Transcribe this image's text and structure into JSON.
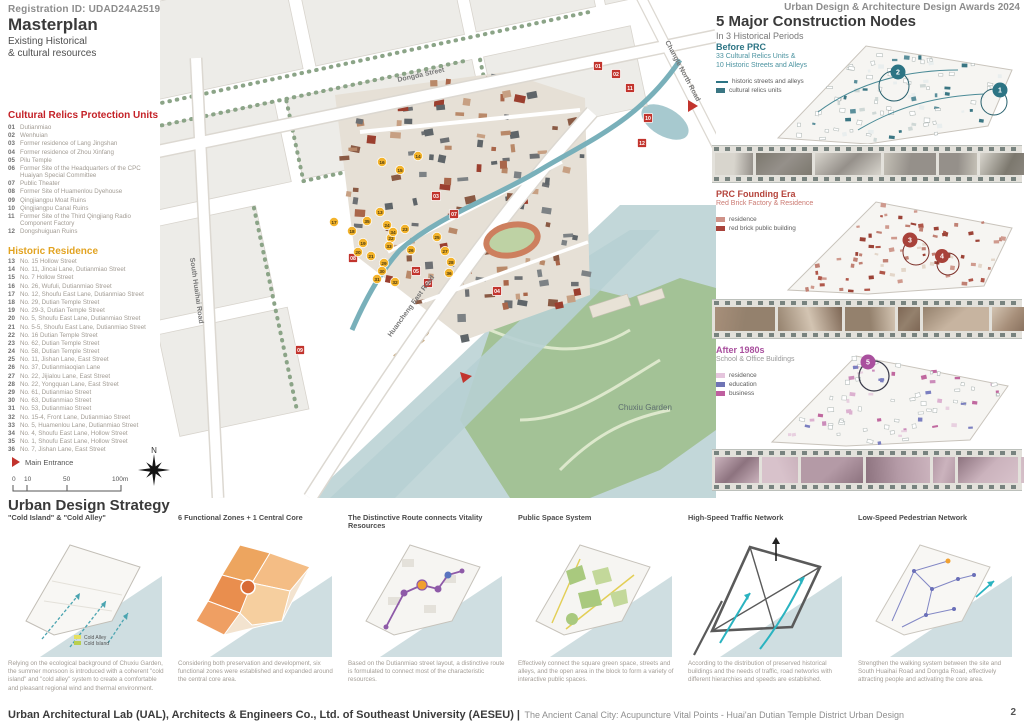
{
  "colors": {
    "relics_red": "#c42127",
    "residence_amber": "#e2a321",
    "teal": "#2c7484",
    "prc_red": "#b5443c",
    "prc_red_light": "#cb7a72",
    "purple": "#a9509e"
  },
  "header": {
    "registration": "Registration ID: UDAD24A2519",
    "title": "Masterplan",
    "subtitle1": "Existing Historical",
    "subtitle2": "& cultural resources"
  },
  "relics": {
    "heading": "Cultural Relics Protection Units",
    "items": [
      {
        "num": "01",
        "label": "Dutianmiao"
      },
      {
        "num": "02",
        "label": "Wenhuian"
      },
      {
        "num": "03",
        "label": "Former residence of Lang Jingshan"
      },
      {
        "num": "04",
        "label": "Former residence of Zhou Xinfang"
      },
      {
        "num": "05",
        "label": "Pilu Temple"
      },
      {
        "num": "06",
        "label": "Former Site of the Headquarters of the CPC Huaiyan Special Committee"
      },
      {
        "num": "07",
        "label": "Public Theater"
      },
      {
        "num": "08",
        "label": "Former Site of Huamenlou Dyehouse"
      },
      {
        "num": "09",
        "label": "Qingjiangpu Moat Ruins"
      },
      {
        "num": "10",
        "label": "Qingjiangpu Canal Ruins"
      },
      {
        "num": "11",
        "label": "Former Site of the Third Qingjiang Radio Component Factory"
      },
      {
        "num": "12",
        "label": "Dongshuiguan Ruins"
      }
    ]
  },
  "residence": {
    "heading": "Historic Residence",
    "items": [
      {
        "num": "13",
        "label": "No. 15 Hollow Street"
      },
      {
        "num": "14",
        "label": "No. 11, Jincai Lane, Dutianmiao Street"
      },
      {
        "num": "15",
        "label": "No. 7 Hollow Street"
      },
      {
        "num": "16",
        "label": "No. 26, Wufuli, Dutianmiao Street"
      },
      {
        "num": "17",
        "label": "No. 12, Shoufu East Lane, Dutianmiao Street"
      },
      {
        "num": "18",
        "label": "No. 29, Dutian Temple Street"
      },
      {
        "num": "19",
        "label": "No. 29-3, Dutian Temple Street"
      },
      {
        "num": "20",
        "label": "No. 5, Shoufu East Lane, Dutianmiao Street"
      },
      {
        "num": "21",
        "label": "No. 5-5, Shoufu East Lane, Dutianmiao Street"
      },
      {
        "num": "22",
        "label": "No. 16 Dutian Temple Street"
      },
      {
        "num": "23",
        "label": "No. 62, Dutian Temple Street"
      },
      {
        "num": "24",
        "label": "No. 58, Dutian Temple Street"
      },
      {
        "num": "25",
        "label": "No. 11, Jishan Lane, East Street"
      },
      {
        "num": "26",
        "label": "No. 37, Dutianmiaoqian Lane"
      },
      {
        "num": "27",
        "label": "No. 22, Jijialou Lane, East Street"
      },
      {
        "num": "28",
        "label": "No. 22, Yongquan Lane, East Street"
      },
      {
        "num": "29",
        "label": "No. 61, Dutianmiao Street"
      },
      {
        "num": "30",
        "label": "No. 63, Dutianmiao Street"
      },
      {
        "num": "31",
        "label": "No. 53, Dutianmiao Street"
      },
      {
        "num": "32",
        "label": "No. 15-4, Front Lane, Dutianmiao Street"
      },
      {
        "num": "33",
        "label": "No. 5, Huamenlou Lane, Dutianmiao Street"
      },
      {
        "num": "34",
        "label": "No. 4, Shoufu East Lane, Hollow Street"
      },
      {
        "num": "35",
        "label": "No. 1, Shoufu East Lane, Hollow Street"
      },
      {
        "num": "36",
        "label": "No. 7, Jishan Lane, East Street"
      }
    ]
  },
  "map": {
    "entrance": "Main Entrance",
    "north": "N",
    "park": "Chuxiu Garden",
    "scale": [
      "0",
      "10",
      "50",
      "100m"
    ],
    "streets": {
      "dongda": "Dongda Street",
      "changle": "Changle North Road",
      "huaihai": "South Huaihai Road",
      "huancheng": "Huancheng East Road"
    },
    "red_markers": [
      {
        "n": "01",
        "x": 438,
        "y": 66
      },
      {
        "n": "02",
        "x": 456,
        "y": 74
      },
      {
        "n": "11",
        "x": 470,
        "y": 88
      },
      {
        "n": "10",
        "x": 488,
        "y": 118
      },
      {
        "n": "12",
        "x": 482,
        "y": 143
      },
      {
        "n": "03",
        "x": 276,
        "y": 196
      },
      {
        "n": "07",
        "x": 294,
        "y": 214
      },
      {
        "n": "08",
        "x": 193,
        "y": 258
      },
      {
        "n": "05",
        "x": 256,
        "y": 271
      },
      {
        "n": "06",
        "x": 268,
        "y": 283
      },
      {
        "n": "04",
        "x": 337,
        "y": 291
      },
      {
        "n": "09",
        "x": 140,
        "y": 350
      }
    ],
    "yellow_markers": [
      {
        "n": "13",
        "x": 220,
        "y": 212
      },
      {
        "n": "14",
        "x": 258,
        "y": 156
      },
      {
        "n": "15",
        "x": 240,
        "y": 170
      },
      {
        "n": "16",
        "x": 222,
        "y": 162
      },
      {
        "n": "17",
        "x": 174,
        "y": 222
      },
      {
        "n": "18",
        "x": 192,
        "y": 231
      },
      {
        "n": "19",
        "x": 203,
        "y": 243
      },
      {
        "n": "20",
        "x": 198,
        "y": 252
      },
      {
        "n": "21",
        "x": 211,
        "y": 256
      },
      {
        "n": "22",
        "x": 231,
        "y": 238
      },
      {
        "n": "23",
        "x": 245,
        "y": 229
      },
      {
        "n": "24",
        "x": 227,
        "y": 225
      },
      {
        "n": "25",
        "x": 277,
        "y": 237
      },
      {
        "n": "26",
        "x": 251,
        "y": 250
      },
      {
        "n": "27",
        "x": 285,
        "y": 251
      },
      {
        "n": "28",
        "x": 291,
        "y": 262
      },
      {
        "n": "29",
        "x": 224,
        "y": 263
      },
      {
        "n": "30",
        "x": 222,
        "y": 271
      },
      {
        "n": "31",
        "x": 217,
        "y": 279
      },
      {
        "n": "32",
        "x": 235,
        "y": 282
      },
      {
        "n": "33",
        "x": 229,
        "y": 246
      },
      {
        "n": "34",
        "x": 233,
        "y": 232
      },
      {
        "n": "35",
        "x": 207,
        "y": 221
      },
      {
        "n": "36",
        "x": 289,
        "y": 273
      }
    ]
  },
  "right": {
    "award": "Urban Design & Architecture Design Awards 2024",
    "title": "5 Major Construction Nodes",
    "subtitle": "In 3 Historical Periods",
    "panels": [
      {
        "title": "Before PRC",
        "sub1": "33 Cultural Relics Units &",
        "sub2": "10 Historic Streets and Alleys",
        "legend": [
          {
            "type": "line",
            "color": "#2c7484",
            "label": "historic streets and alleys"
          },
          {
            "type": "box",
            "color": "#3a7683",
            "label": "cultural relics units"
          }
        ],
        "nodes": [
          "2",
          "1"
        ]
      },
      {
        "title": "PRC Founding Era",
        "sub1": "Red Brick Factory & Residence",
        "legend": [
          {
            "type": "box",
            "color": "#cf9288",
            "label": "residence"
          },
          {
            "type": "box",
            "color": "#a8423a",
            "label": "red brick public building"
          }
        ],
        "nodes": [
          "3",
          "4"
        ]
      },
      {
        "title": "After 1980s",
        "sub1": "School & Office Buildings",
        "legend": [
          {
            "type": "box",
            "color": "#e5c5dd",
            "label": "residence"
          },
          {
            "type": "box",
            "color": "#6f74b5",
            "label": "education"
          },
          {
            "type": "box",
            "color": "#bf5f9f",
            "label": "business"
          }
        ],
        "nodes": [
          "5"
        ]
      }
    ]
  },
  "strategy": {
    "heading": "Urban Design Strategy",
    "cold_legend": [
      "Cold Alley",
      "Cold Island"
    ],
    "cards": [
      {
        "caption": "\"Cold Island\" & \"Cold Alley\"",
        "text": "Relying on the ecological background of Chuxiu Garden, the summer monsoon is introduced with a coherent \"cold island\" and \"cold alley\" system to create a comfortable and pleasant regional wind and thermal environment."
      },
      {
        "caption": "6 Functional Zones + 1 Central Core",
        "text": "Considering both preservation and development, six functional zones were established and expanded around the central core area."
      },
      {
        "caption": "The Distinctive Route connects Vitality Resources",
        "text": "Based on the Dutianmiao street layout, a distinctive route is formulated to connect most of the characteristic resources."
      },
      {
        "caption": "Public Space System",
        "text": "Effectively connect the square green space, streets and alleys, and the open area in the block to form a variety of interactive public spaces."
      },
      {
        "caption": "High-Speed Traffic Network",
        "text": "According to the distribution of preserved historical buildings and the needs of traffic, road networks with different hierarchies and speeds are established."
      },
      {
        "caption": "Low-Speed Pedestrian Network",
        "text": "Strengthen the walking system between the site and South Huaihai Road and Dongda Road, effectively attracting people and activating the core area."
      }
    ]
  },
  "footer": {
    "org": "Urban Architectural Lab (UAL), Architects & Engineers Co., Ltd. of Southeast University (AESEU) |",
    "proj": "The Ancient Canal City: Acupuncture Vital Points - Huai'an Dutian Temple District Urban Design",
    "page": "2"
  }
}
